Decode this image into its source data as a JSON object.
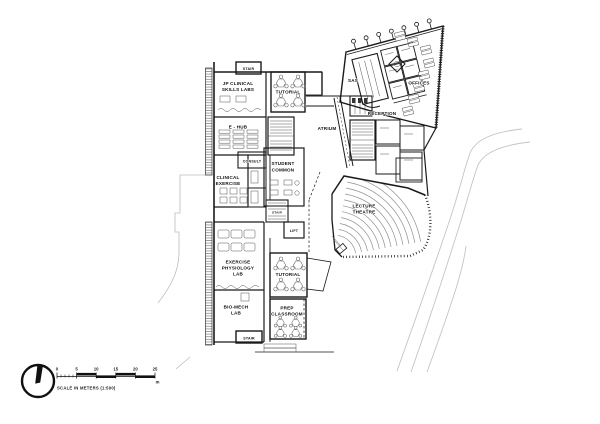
{
  "drawing": {
    "rooms": {
      "stair_top": "STAIR",
      "jp_clinical_1": "JP CLINICAL",
      "jp_clinical_2": "SKILLS LABS",
      "tutorial_top": "TUTORIAL",
      "e_hub": "E - HUB",
      "consult": "CONSULT",
      "clinical_1": "CLINICAL",
      "clinical_2": "EXERCISE",
      "student_1": "STUDENT",
      "student_2": "COMMON",
      "atrium": "ATRIUM",
      "reception": "RECEPTION",
      "sas": "SAS",
      "offices": "OFFICES",
      "stair_mid": "STAIR",
      "lift": "LIFT",
      "lecture_1": "LECTURE",
      "lecture_2": "THEATRE",
      "exphys_1": "EXERCISE",
      "exphys_2": "PHYSIOLOGY",
      "exphys_3": "LAB",
      "biomech_1": "BIO-MECH",
      "biomech_2": "LAB",
      "tutorial_bottom": "TUTORIAL",
      "prep_1": "PREP",
      "prep_2": "CLASSROOM",
      "stair_bottom": "STAIR"
    },
    "scale_bar": {
      "ticks": [
        "0",
        "5",
        "10",
        "15",
        "20",
        "25"
      ],
      "unit": "m",
      "caption": "SCALE IN METERS (1:500)"
    },
    "colors": {
      "ink": "#1a1a1a",
      "furniture": "#555555",
      "seating": "#909090",
      "site": "#c4c4c4",
      "paper": "#ffffff"
    }
  }
}
